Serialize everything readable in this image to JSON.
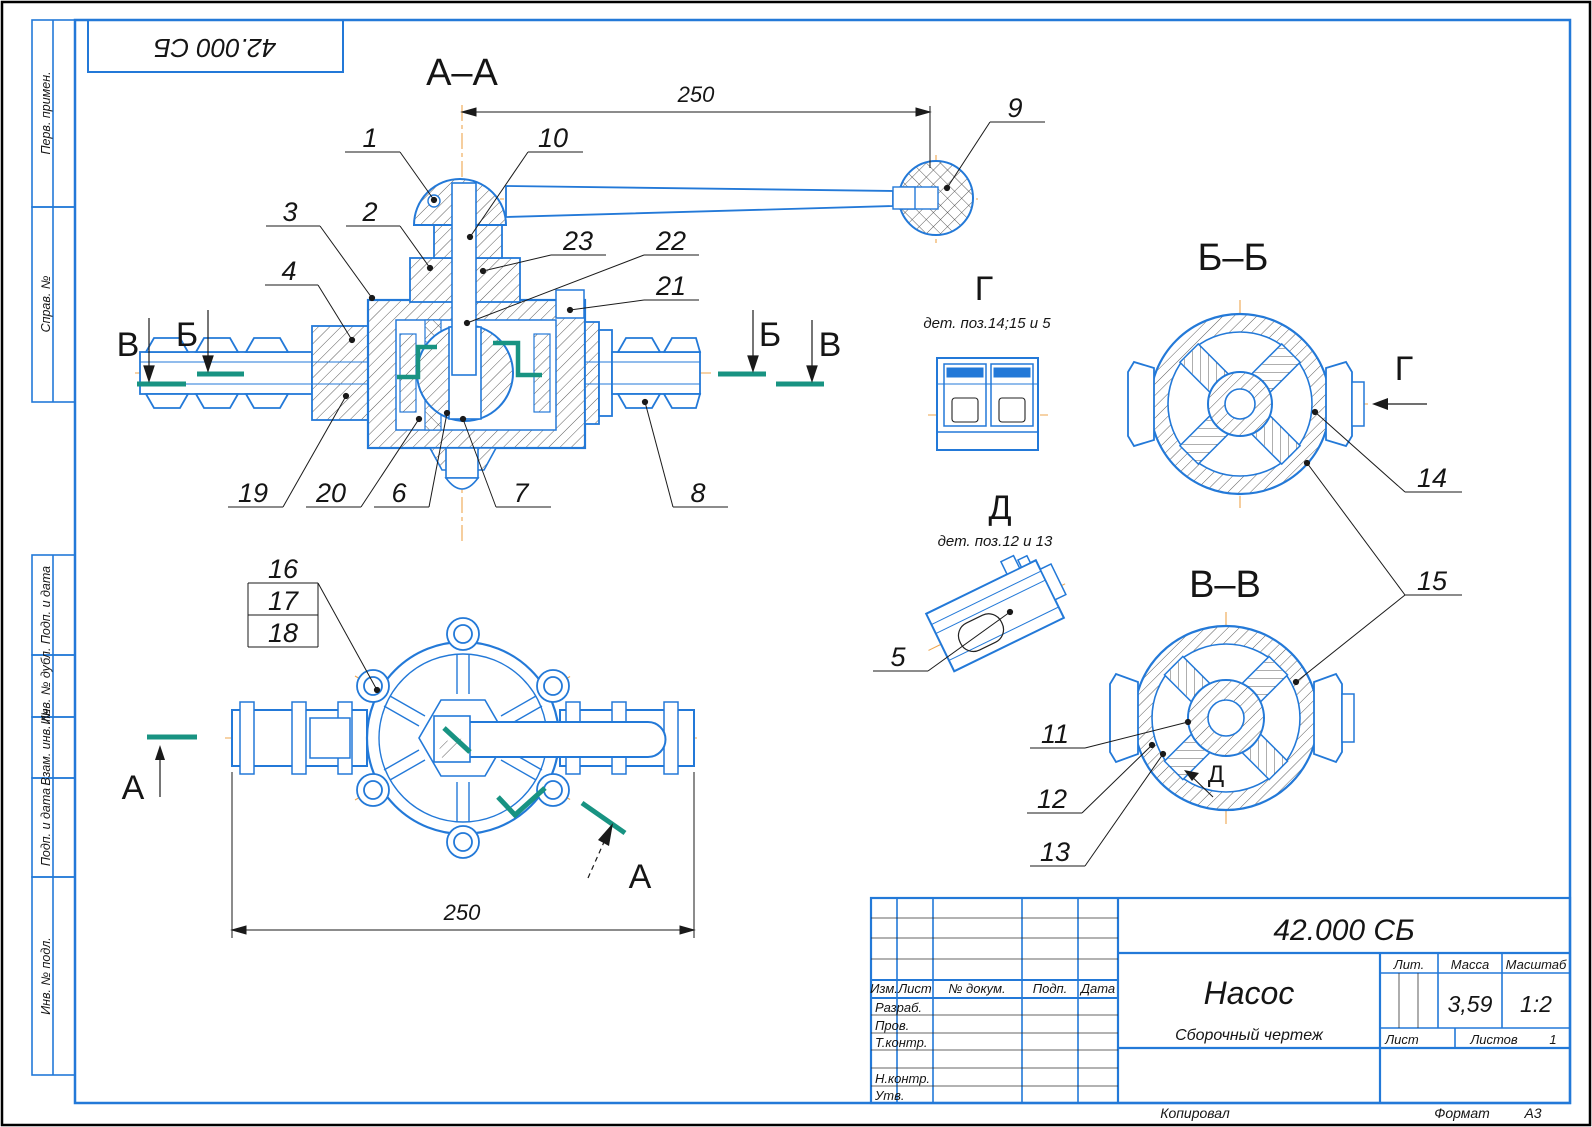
{
  "frame": {
    "stamp": "42.000 СБ",
    "side_labels": [
      "Перв. примен.",
      "Справ. №",
      "Подп. и дата",
      "Инв. № дубл.",
      "Взам. инв. №",
      "Подп. и дата",
      "Инв. № подл."
    ],
    "footer": {
      "kopiroval": "Копировал",
      "format_label": "Формат",
      "format_value": "А3"
    }
  },
  "drawing": {
    "aa_title": "А–А",
    "bb_title": "Б–Б",
    "vv_title": "В–В",
    "g_title": "Г",
    "g_note": "дет. поз.14;15 и 5",
    "d_title": "Д",
    "d_note": "дет. поз.12 и 13",
    "d_inner": "Д",
    "g_arrow": "Г",
    "dim_aa": "250",
    "dim_bottom": "250",
    "sec_v_left": "В",
    "sec_b_left": "Б",
    "sec_b_right": "Б",
    "sec_v_right": "В",
    "view_a_left": "А",
    "view_a_bottom": "А"
  },
  "callouts": {
    "c1": "1",
    "c2": "2",
    "c3": "3",
    "c4": "4",
    "c5": "5",
    "c6": "6",
    "c7": "7",
    "c8": "8",
    "c9": "9",
    "c10": "10",
    "c11": "11",
    "c12": "12",
    "c13": "13",
    "c14": "14",
    "c15": "15",
    "c16": "16",
    "c17": "17",
    "c18": "18",
    "c19": "19",
    "c20": "20",
    "c21": "21",
    "c22": "22",
    "c23": "23"
  },
  "title_block": {
    "doc_number": "42.000 СБ",
    "name": "Насос",
    "doc_type": "Сборочный чертеж",
    "h_izm": "Изм.",
    "h_list": "Лист",
    "h_doc": "№ докум.",
    "h_podp": "Подп.",
    "h_data": "Дата",
    "r_razrab": "Разраб.",
    "r_prov": "Пров.",
    "r_tkontr": "Т.контр.",
    "r_nkontr": "Н.контр.",
    "r_utv": "Утв.",
    "h_lit": "Лит.",
    "h_massa": "Масса",
    "h_masshtab": "Масштаб",
    "v_massa": "3,59",
    "v_masshtab": "1:2",
    "h_list2": "Лист",
    "h_listov": "Листов",
    "v_listov": "1"
  }
}
